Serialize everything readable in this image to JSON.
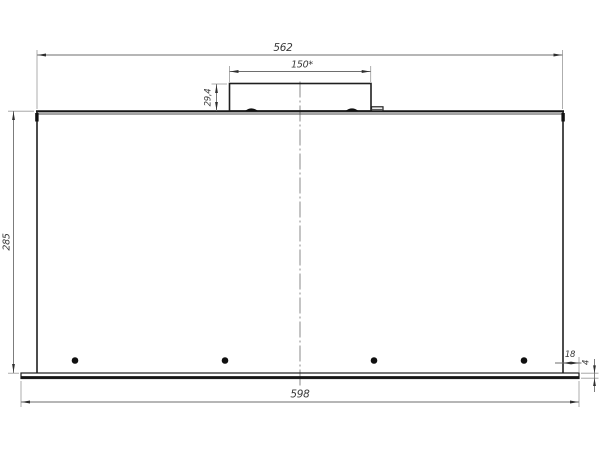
{
  "drawing": {
    "view_name": "hood-front-view-technical-drawing",
    "labels": {
      "total_width": "562",
      "duct_width": "150*",
      "duct_height": "29,4",
      "body_height": "285",
      "base_width": "598",
      "base_overhang": "18",
      "base_thickness": "4"
    },
    "colors": {
      "object_line": "#1f1f1f",
      "dimension_line": "#6e6e6e",
      "extension_line": "#9a9a9a",
      "text": "#3a3a3a",
      "background": "#ffffff"
    }
  }
}
